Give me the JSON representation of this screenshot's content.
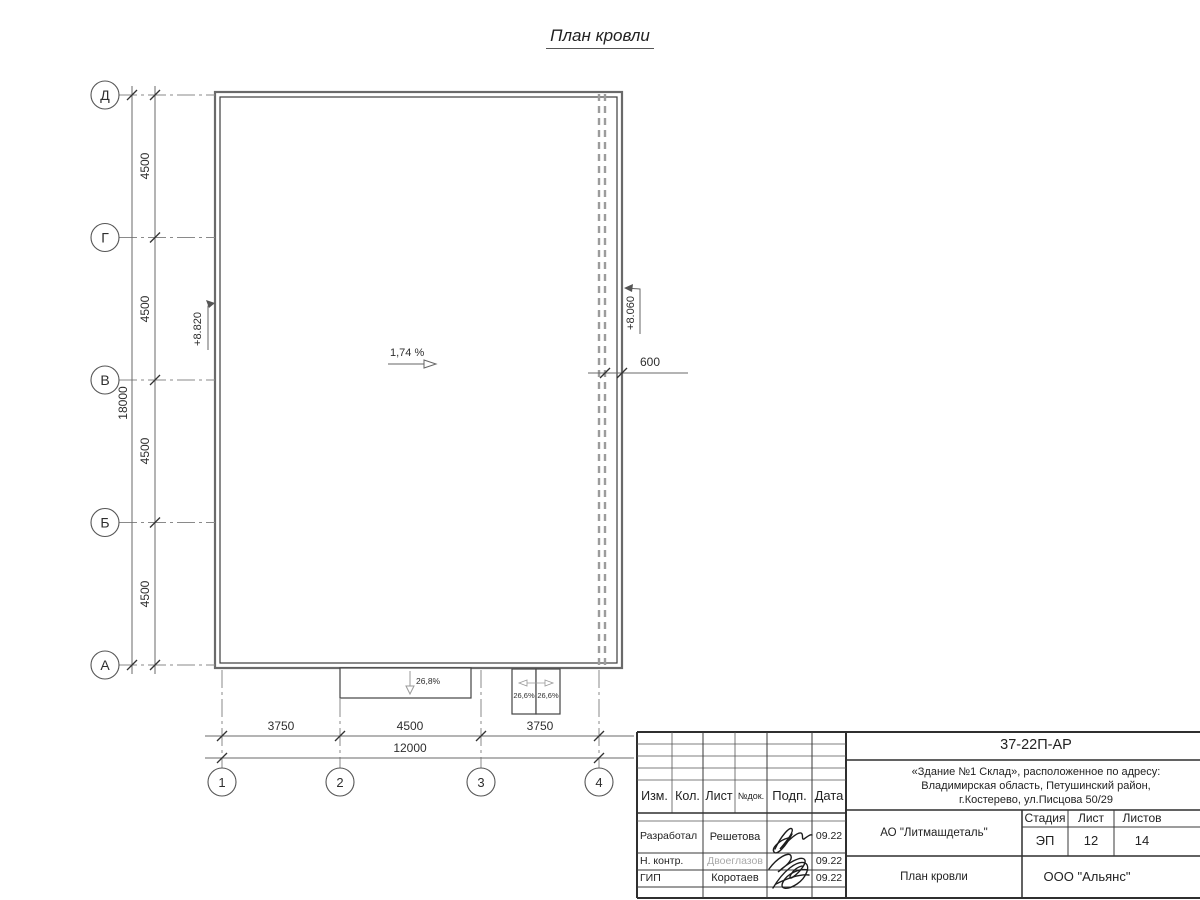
{
  "sheet": {
    "title": "План кровли"
  },
  "plan": {
    "axes_rows": [
      "Д",
      "Г",
      "В",
      "Б",
      "А"
    ],
    "axes_cols": [
      "1",
      "2",
      "3",
      "4"
    ],
    "dims_left": [
      "4500",
      "4500",
      "4500",
      "4500"
    ],
    "dim_left_total": "18000",
    "dims_bottom": [
      "3750",
      "4500",
      "3750"
    ],
    "dim_bottom_total": "12000",
    "dim_gutter": "600",
    "slope_main": "1,74 %",
    "elev_left": "+8.820",
    "elev_right": "+8.060",
    "canopy_slope": "26,8%",
    "canopy_slopes_small": [
      "26,6%",
      "26,6%"
    ]
  },
  "titleblock": {
    "doc_number": "37-22П-АР",
    "project_lines": [
      "«Здание №1 Склад», расположенное по адресу:",
      "Владимирская область, Петушинский район,",
      "г.Костерево, ул.Писцова 50/29"
    ],
    "client": "АО \"Литмашдеталь\"",
    "sheet_title": "План кровли",
    "company": "ООО \"Альянс\"",
    "cols": {
      "izm": "Изм.",
      "kol": "Кол.",
      "list": "Лист",
      "ndok": "№док.",
      "podp": "Подп.",
      "data": "Дата"
    },
    "stage": {
      "label": "Стадия",
      "value": "ЭП"
    },
    "sheet": {
      "label": "Лист",
      "value": "12"
    },
    "sheets": {
      "label": "Листов",
      "value": "14"
    },
    "people": [
      {
        "role": "Разработал",
        "name": "Решетова",
        "date": "09.22"
      },
      {
        "role": "Н. контр.",
        "name": "Двоеглазов",
        "date": "09.22"
      },
      {
        "role": "ГИП",
        "name": "Коротаев",
        "date": "09.22"
      }
    ]
  }
}
